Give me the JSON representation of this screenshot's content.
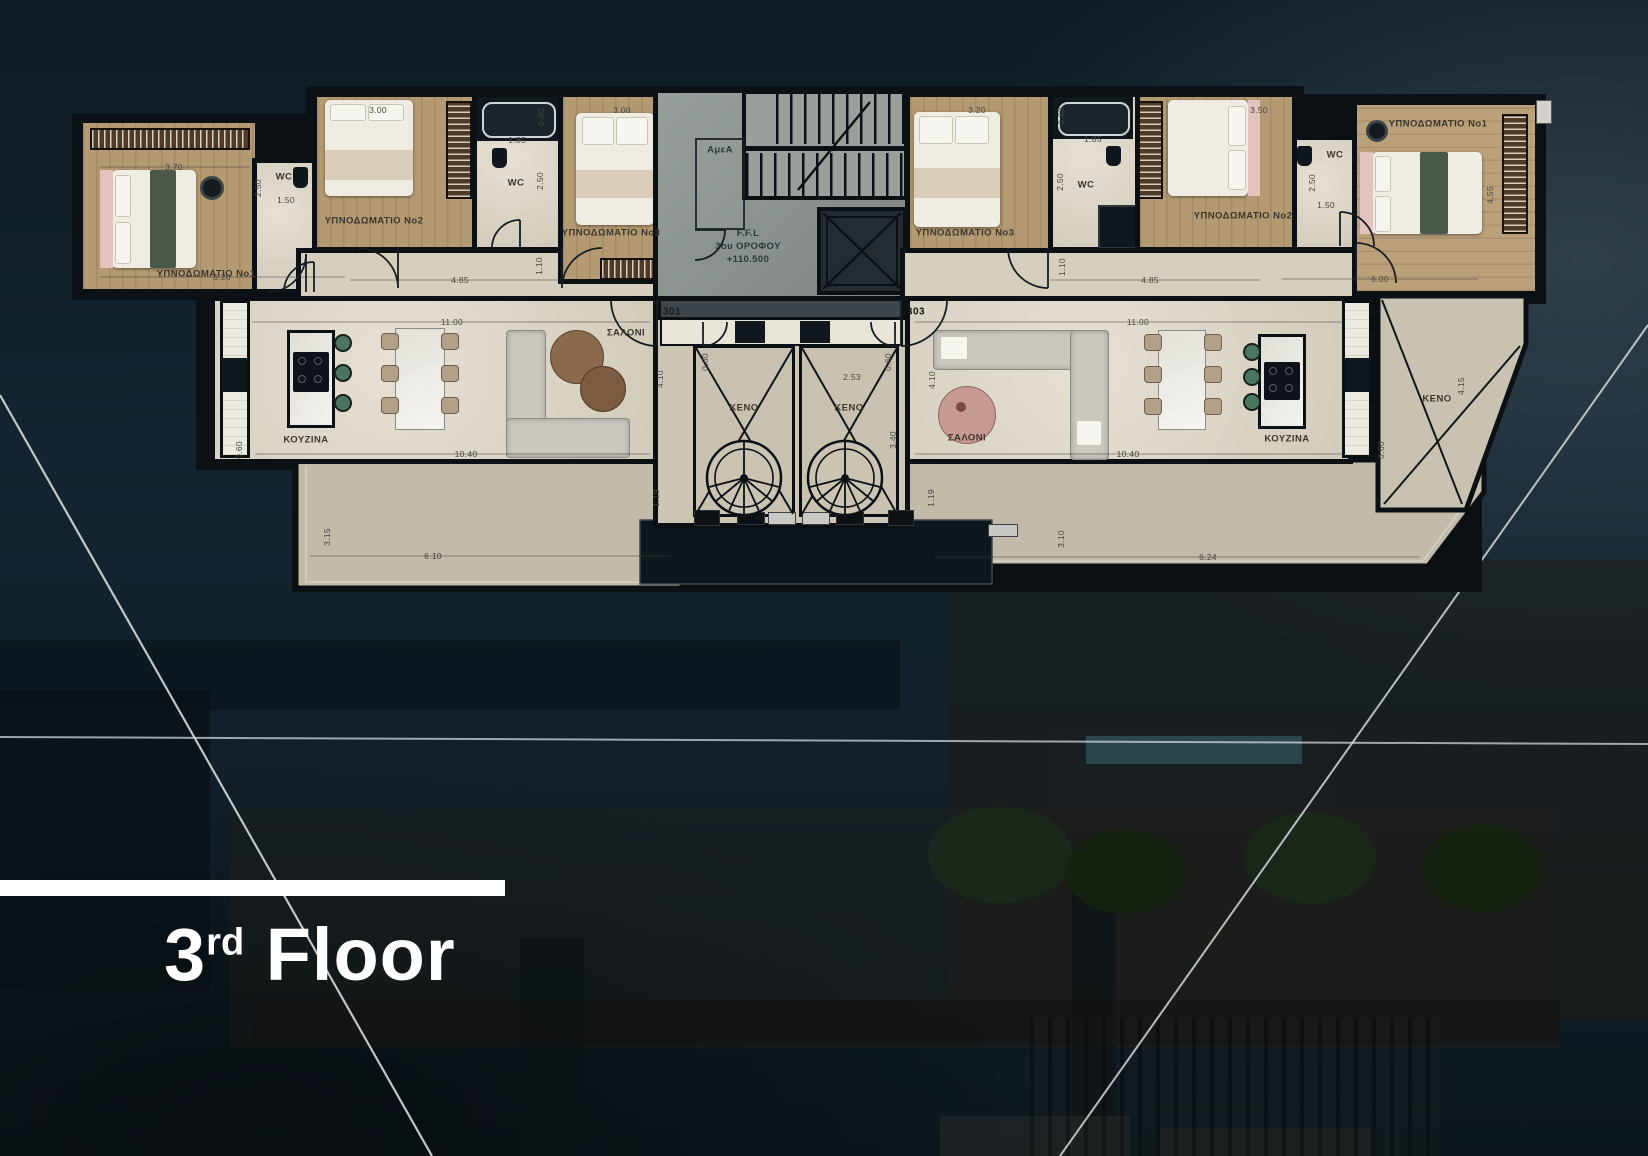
{
  "title": {
    "number": "3",
    "suffix": "rd",
    "word": "Floor"
  },
  "plan": {
    "units": {
      "left": "301",
      "right": "303"
    },
    "core": {
      "amea": "ΑμεΑ",
      "ffl1": "F.F.L",
      "ffl2": "3ου ΟΡΟΦΟΥ",
      "ffl3": "+110.500"
    },
    "rooms": {
      "bed1_left": "ΥΠΝΟΔΩΜΑΤΙΟ Νο1",
      "bed2_left": "ΥΠΝΟΔΩΜΑΤΙΟ Νο2",
      "bed3_left": "ΥΠΝΟΔΩΜΑΤΙΟ Νο3",
      "bed1_right": "ΥΠΝΟΔΩΜΑΤΙΟ Νο1",
      "bed2_right": "ΥΠΝΟΔΩΜΑΤΙΟ Νο2",
      "bed3_right": "ΥΠΝΟΔΩΜΑΤΙΟ Νο3",
      "wc_left_a": "WC",
      "wc_left_b": "WC",
      "wc_right_a": "WC",
      "wc_right_b": "WC",
      "kitchen_left": "ΚΟΥΖΙΝΑ",
      "kitchen_right": "ΚΟΥΖΙΝΑ",
      "living_left": "ΣΑΛΟΝΙ",
      "living_right": "ΣΑΛΟΝΙ",
      "keno_a": "ΚΕΝΟ",
      "keno_b": "ΚΕΝΟ",
      "keno_c": "ΚΕΝΟ"
    },
    "dims": {
      "d370": "3.70",
      "d620": "6.20",
      "d250a": "2.50",
      "d150a": "1.50",
      "d300a": "3.00",
      "d080a": "0.80",
      "d185a": "1.85",
      "d250b": "2.50",
      "d110a": "1.10",
      "d485a": "4.85",
      "d300b": "3.00",
      "d320": "3.20",
      "d080b": "0.80",
      "d185b": "1.85",
      "d250c": "2.50",
      "d110b": "1.10",
      "d485b": "4.85",
      "d350": "3.50",
      "d250d": "2.50",
      "d150b": "1.50",
      "d455": "4.55",
      "d600": "6.00",
      "d1100a": "11.00",
      "d1040a": "10.40",
      "d060a": "0.60",
      "d410a": "4.10",
      "d253": "2.53",
      "d340": "3.40",
      "d410b": "4.10",
      "d060c": "0.60",
      "d060d": "0.60",
      "d119a": "1.19",
      "d119b": "1.19",
      "d1100b": "11.00",
      "d1040b": "10.40",
      "d060b": "0.60",
      "d415": "4.15",
      "d315": "3.15",
      "d610": "6.10",
      "d310": "3.10",
      "d624": "6.24"
    }
  }
}
